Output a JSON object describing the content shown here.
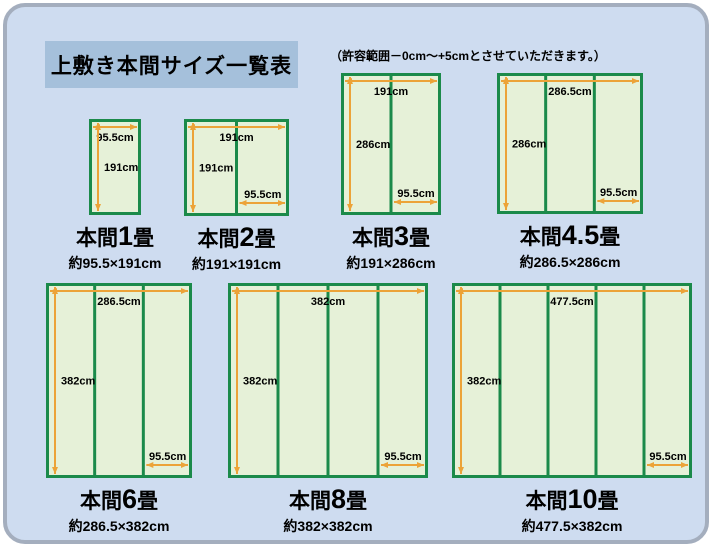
{
  "title": "上敷き本間サイズ一覧表",
  "note": "（許容範囲－0cm～+5cmとさせていただきます。）",
  "colors": {
    "page_bg": "#cedcf0",
    "frame_border": "#a4aebe",
    "title_bg": "#a5c0db",
    "mat_fill": "#e6f1d8",
    "mat_border": "#1b8a4a",
    "arrow": "#eca338",
    "text": "#000000"
  },
  "diagrams": [
    {
      "name_prefix": "本間",
      "name_number": "1",
      "name_suffix": "畳",
      "dims": "約95.5×191cm",
      "top_label": "95.5cm",
      "side_label": "191cm",
      "panel_label": null,
      "panels": 1,
      "x": 89,
      "y": 119,
      "w": 52,
      "h": 96
    },
    {
      "name_prefix": "本間",
      "name_number": "2",
      "name_suffix": "畳",
      "dims": "約191×191cm",
      "top_label": "191cm",
      "side_label": "191cm",
      "panel_label": "95.5cm",
      "panels": 2,
      "x": 184,
      "y": 119,
      "w": 105,
      "h": 97
    },
    {
      "name_prefix": "本間",
      "name_number": "3",
      "name_suffix": "畳",
      "dims": "約191×286cm",
      "top_label": "191cm",
      "side_label": "286cm",
      "panel_label": "95.5cm",
      "panels": 2,
      "x": 341,
      "y": 73,
      "w": 100,
      "h": 142
    },
    {
      "name_prefix": "本間",
      "name_number": "4.5",
      "name_suffix": "畳",
      "dims": "約286.5×286cm",
      "top_label": "286.5cm",
      "side_label": "286cm",
      "panel_label": "95.5cm",
      "panels": 3,
      "x": 497,
      "y": 73,
      "w": 146,
      "h": 141
    },
    {
      "name_prefix": "本間",
      "name_number": "6",
      "name_suffix": "畳",
      "dims": "約286.5×382cm",
      "top_label": "286.5cm",
      "side_label": "382cm",
      "panel_label": "95.5cm",
      "panels": 3,
      "x": 46,
      "y": 283,
      "w": 146,
      "h": 195
    },
    {
      "name_prefix": "本間",
      "name_number": "8",
      "name_suffix": "畳",
      "dims": "約382×382cm",
      "top_label": "382cm",
      "side_label": "382cm",
      "panel_label": "95.5cm",
      "panels": 4,
      "x": 228,
      "y": 283,
      "w": 200,
      "h": 195
    },
    {
      "name_prefix": "本間",
      "name_number": "10",
      "name_suffix": "畳",
      "dims": "約477.5×382cm",
      "top_label": "477.5cm",
      "side_label": "382cm",
      "panel_label": "95.5cm",
      "panels": 5,
      "x": 452,
      "y": 283,
      "w": 240,
      "h": 195
    }
  ]
}
